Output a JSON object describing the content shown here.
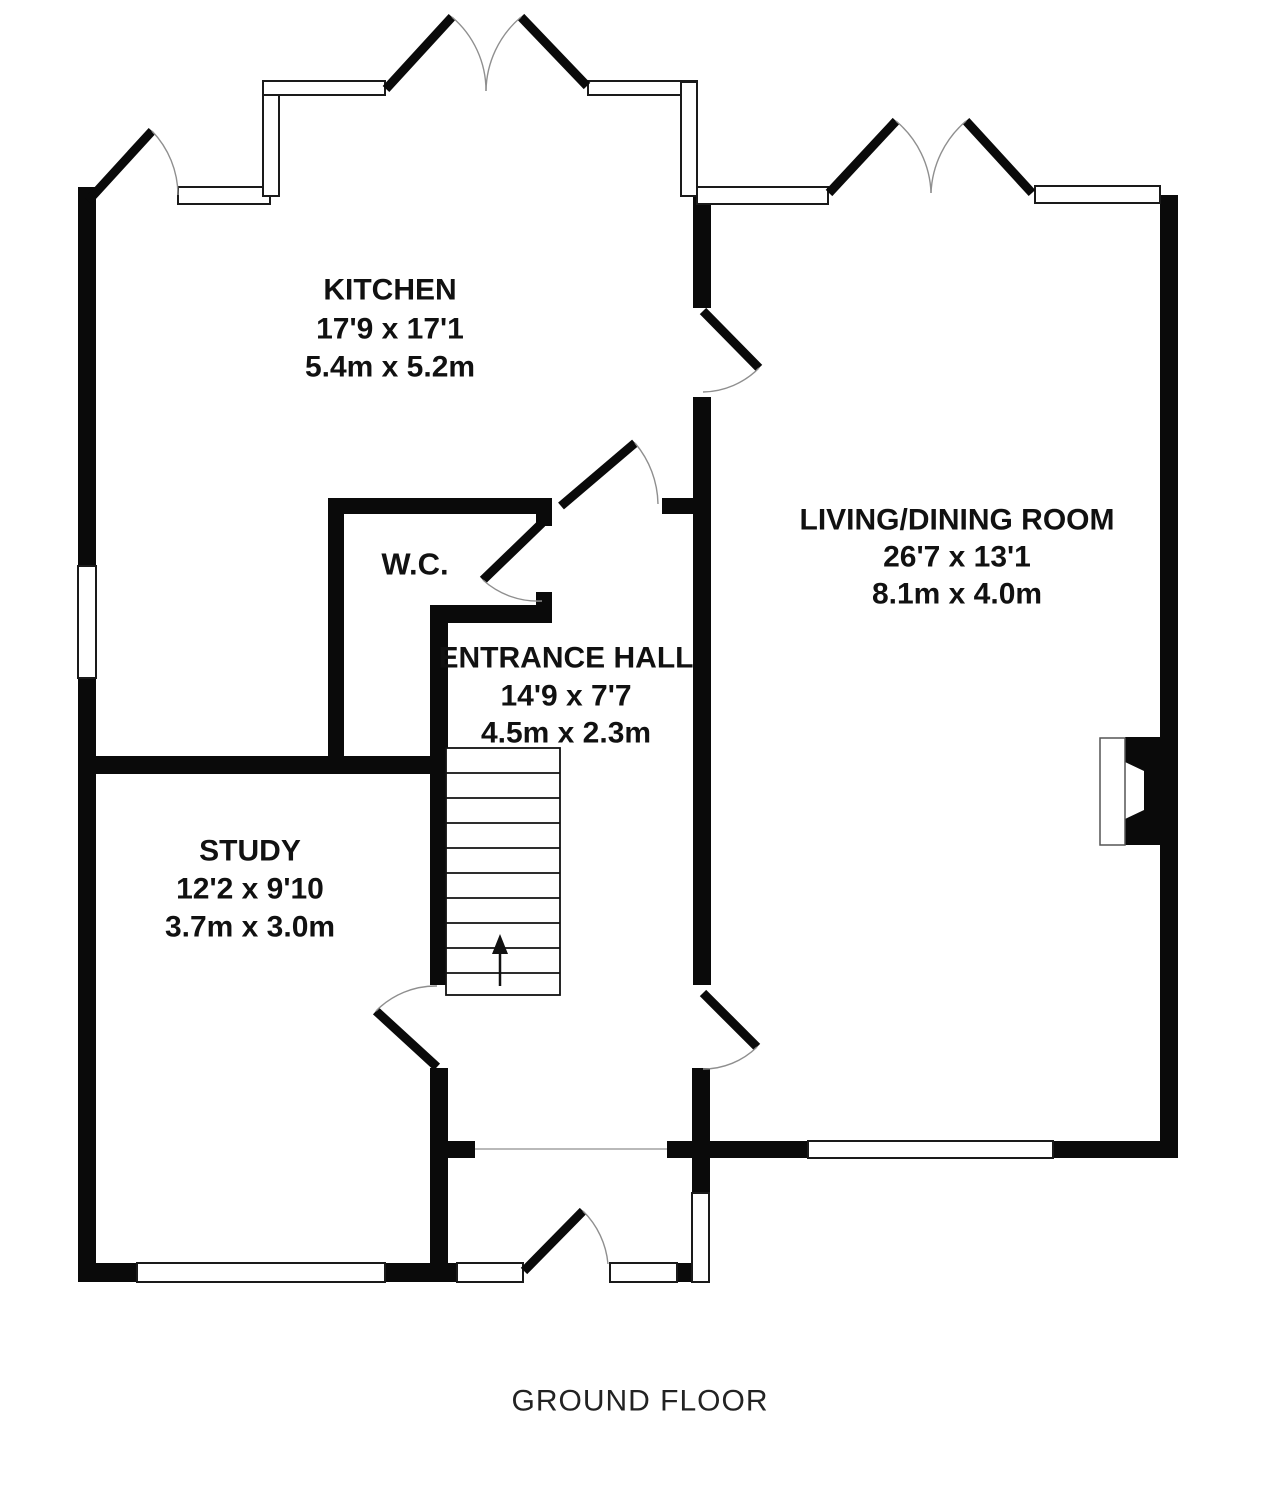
{
  "plan_title": "GROUND FLOOR",
  "rooms": {
    "kitchen": {
      "name": "KITCHEN",
      "size_imperial": "17'9 x 17'1",
      "size_metric": "5.4m x 5.2m"
    },
    "living_dining": {
      "name": "LIVING/DINING ROOM",
      "size_imperial": "26'7 x 13'1",
      "size_metric": "8.1m x 4.0m"
    },
    "entrance_hall": {
      "name": "ENTRANCE HALL",
      "size_imperial": "14'9 x 7'7",
      "size_metric": "4.5m x 2.3m"
    },
    "study": {
      "name": "STUDY",
      "size_imperial": "12'2 x 9'10",
      "size_metric": "3.7m x 3.0m"
    },
    "wc": {
      "name": "W.C."
    }
  },
  "colors": {
    "walls": "#0a0a0a",
    "background": "#ffffff",
    "text": "#111111",
    "door_arc": "#8f8f8f"
  }
}
